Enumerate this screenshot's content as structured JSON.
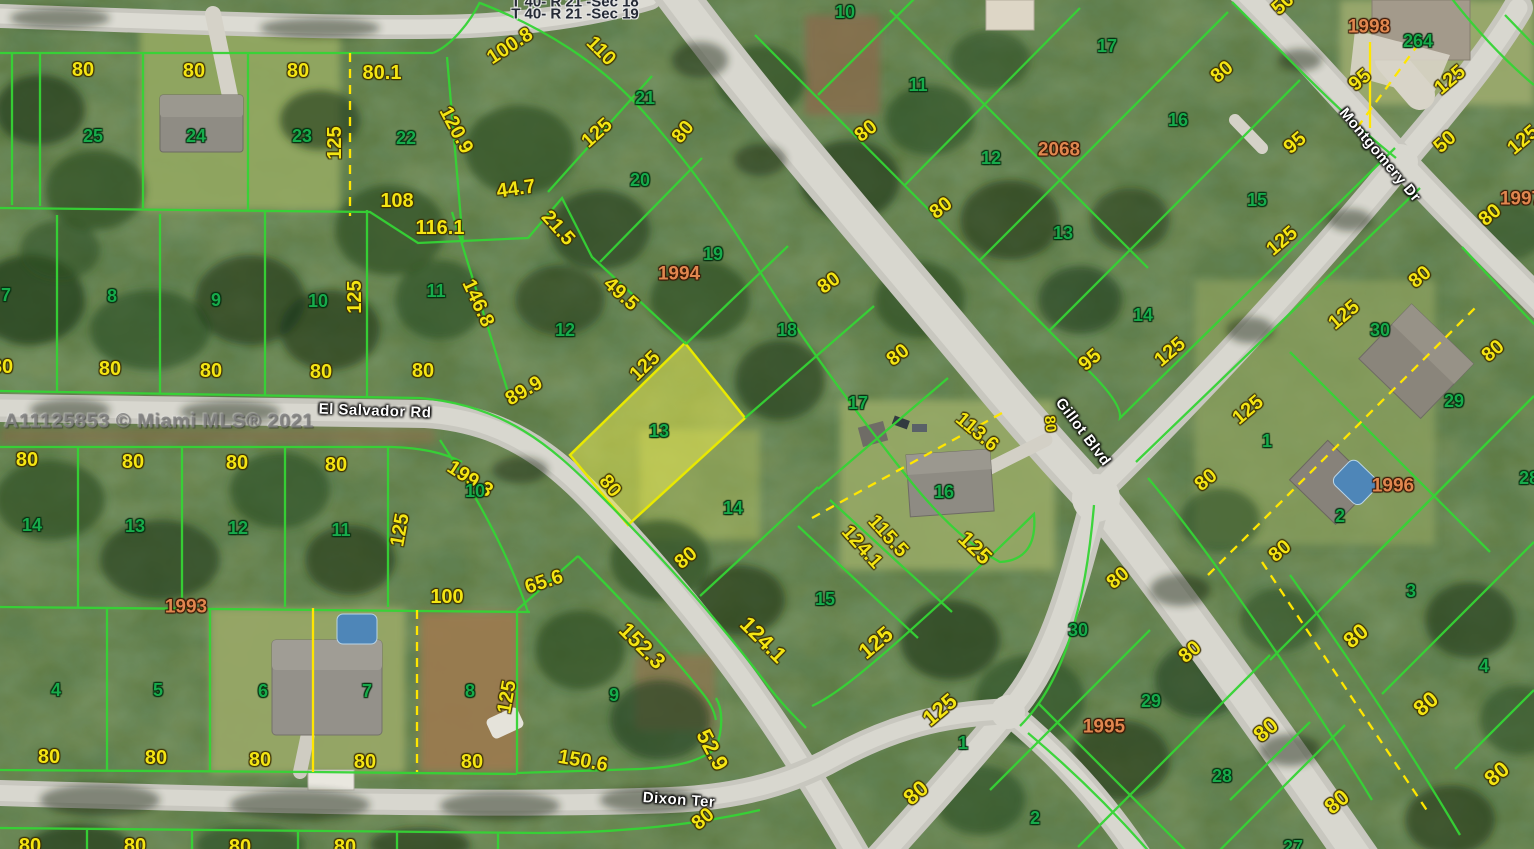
{
  "map": {
    "watermark": "A11125853 © Miami MLS® 2021",
    "section_labels": [
      "T 40- R 21 -Sec 18",
      "T 40- R 21 -Sec 19"
    ],
    "streets": [
      "El Salvador Rd",
      "Dixon Ter",
      "Gillot Blvd",
      "Montgomery Dr"
    ],
    "highlighted_lot": {
      "number": "13",
      "fill": "rgba(235,235,80,0.5)",
      "outline": "#e9e900"
    },
    "colors": {
      "parcel_line": "#35d435",
      "dimension_text": "#f4e513",
      "lot_number_text": "#17ab4b",
      "plat_number_text": "#e0874f",
      "boundary_yellow": "#ffe600",
      "street_text": "#ffffff"
    },
    "labels": [
      {
        "t": "T 40- R 21 -Sec 18",
        "x": 575,
        "y": 2,
        "c": "sec"
      },
      {
        "t": "T 40- R 21 -Sec 19",
        "x": 575,
        "y": 14,
        "c": "sec"
      },
      {
        "t": "El Salvador Rd",
        "x": 375,
        "y": 411,
        "r": 2,
        "c": "w"
      },
      {
        "t": "Dixon Ter",
        "x": 679,
        "y": 800,
        "r": 4,
        "c": "w"
      },
      {
        "t": "Gillot Blvd",
        "x": 1083,
        "y": 432,
        "r": 53,
        "c": "w"
      },
      {
        "t": "Montgomery Dr",
        "x": 1380,
        "y": 155,
        "r": 50,
        "c": "w"
      },
      {
        "t": "80",
        "x": 83,
        "y": 70,
        "c": "y"
      },
      {
        "t": "80",
        "x": 194,
        "y": 71,
        "c": "y"
      },
      {
        "t": "80",
        "x": 298,
        "y": 71,
        "c": "y"
      },
      {
        "t": "80.1",
        "x": 382,
        "y": 73,
        "c": "y"
      },
      {
        "t": "100.8",
        "x": 510,
        "y": 46,
        "r": -33,
        "c": "y"
      },
      {
        "t": "110",
        "x": 601,
        "y": 51,
        "r": 45,
        "c": "y"
      },
      {
        "t": "125",
        "x": 335,
        "y": 143,
        "r": -90,
        "c": "y"
      },
      {
        "t": "120.9",
        "x": 456,
        "y": 130,
        "r": 62,
        "c": "y"
      },
      {
        "t": "125",
        "x": 597,
        "y": 133,
        "r": -42,
        "c": "y"
      },
      {
        "t": "80",
        "x": 683,
        "y": 132,
        "r": -50,
        "c": "y"
      },
      {
        "t": "44.7",
        "x": 516,
        "y": 189,
        "r": -8,
        "c": "y"
      },
      {
        "t": "108",
        "x": 397,
        "y": 201,
        "c": "y"
      },
      {
        "t": "116.1",
        "x": 440,
        "y": 228,
        "c": "y"
      },
      {
        "t": "21.5",
        "x": 558,
        "y": 228,
        "r": 48,
        "c": "y"
      },
      {
        "t": "49.5",
        "x": 621,
        "y": 294,
        "r": 42,
        "c": "y"
      },
      {
        "t": "146.8",
        "x": 478,
        "y": 303,
        "r": 65,
        "c": "y"
      },
      {
        "t": "125",
        "x": 645,
        "y": 366,
        "r": -44,
        "c": "y"
      },
      {
        "t": "89.9",
        "x": 524,
        "y": 391,
        "r": -30,
        "c": "y"
      },
      {
        "t": "80",
        "x": 423,
        "y": 371,
        "c": "y"
      },
      {
        "t": "80",
        "x": 2,
        "y": 367,
        "c": "y"
      },
      {
        "t": "80",
        "x": 110,
        "y": 369,
        "c": "y"
      },
      {
        "t": "80",
        "x": 211,
        "y": 371,
        "c": "y"
      },
      {
        "t": "80",
        "x": 321,
        "y": 372,
        "c": "y"
      },
      {
        "t": "125",
        "x": 355,
        "y": 297,
        "r": -90,
        "c": "y"
      },
      {
        "t": "80",
        "x": 610,
        "y": 486,
        "r": 50,
        "c": "y"
      },
      {
        "t": "199.3",
        "x": 470,
        "y": 479,
        "r": 33,
        "c": "y"
      },
      {
        "t": "80",
        "x": 27,
        "y": 460,
        "c": "y"
      },
      {
        "t": "80",
        "x": 133,
        "y": 462,
        "c": "y"
      },
      {
        "t": "80",
        "x": 237,
        "y": 463,
        "c": "y"
      },
      {
        "t": "80",
        "x": 336,
        "y": 465,
        "c": "y"
      },
      {
        "t": "125",
        "x": 400,
        "y": 530,
        "r": -80,
        "c": "y"
      },
      {
        "t": "100",
        "x": 447,
        "y": 597,
        "c": "y"
      },
      {
        "t": "65.6",
        "x": 544,
        "y": 582,
        "r": -18,
        "c": "y"
      },
      {
        "t": "125",
        "x": 507,
        "y": 697,
        "r": -80,
        "c": "y"
      },
      {
        "t": "80",
        "x": 472,
        "y": 762,
        "c": "y"
      },
      {
        "t": "150.6",
        "x": 583,
        "y": 761,
        "r": 10,
        "c": "y"
      },
      {
        "t": "152.3",
        "x": 642,
        "y": 646,
        "r": 45,
        "fs": 22,
        "c": "y"
      },
      {
        "t": "124.1",
        "x": 763,
        "y": 640,
        "r": 45,
        "fs": 22,
        "c": "y"
      },
      {
        "t": "52.9",
        "x": 712,
        "y": 750,
        "r": 62,
        "fs": 22,
        "c": "y"
      },
      {
        "t": "80",
        "x": 49,
        "y": 757,
        "c": "y"
      },
      {
        "t": "80",
        "x": 156,
        "y": 758,
        "c": "y"
      },
      {
        "t": "80",
        "x": 260,
        "y": 760,
        "c": "y"
      },
      {
        "t": "80",
        "x": 365,
        "y": 762,
        "c": "y"
      },
      {
        "t": "80",
        "x": 30,
        "y": 846,
        "c": "y"
      },
      {
        "t": "80",
        "x": 135,
        "y": 846,
        "c": "y"
      },
      {
        "t": "80",
        "x": 240,
        "y": 847,
        "c": "y"
      },
      {
        "t": "80",
        "x": 345,
        "y": 847,
        "c": "y"
      },
      {
        "t": "80",
        "x": 686,
        "y": 558,
        "r": -40,
        "c": "y"
      },
      {
        "t": "124.1",
        "x": 862,
        "y": 547,
        "r": 48,
        "c": "y"
      },
      {
        "t": "115.5",
        "x": 888,
        "y": 536,
        "r": 48,
        "c": "y"
      },
      {
        "t": "125",
        "x": 876,
        "y": 643,
        "r": -40,
        "fs": 22,
        "c": "y"
      },
      {
        "t": "125",
        "x": 940,
        "y": 710,
        "r": -40,
        "fs": 22,
        "c": "y"
      },
      {
        "t": "80",
        "x": 916,
        "y": 793,
        "r": -40,
        "fs": 22,
        "c": "y"
      },
      {
        "t": "125",
        "x": 975,
        "y": 548,
        "r": 44,
        "fs": 22,
        "c": "y"
      },
      {
        "t": "113.6",
        "x": 977,
        "y": 432,
        "r": 40,
        "c": "y"
      },
      {
        "t": "80",
        "x": 1050,
        "y": 424,
        "r": 85,
        "fs": 15,
        "c": "y"
      },
      {
        "t": "80",
        "x": 829,
        "y": 283,
        "r": -36,
        "c": "y"
      },
      {
        "t": "80",
        "x": 898,
        "y": 355,
        "r": -38,
        "c": "y"
      },
      {
        "t": "80",
        "x": 866,
        "y": 131,
        "r": -38,
        "c": "y"
      },
      {
        "t": "80",
        "x": 941,
        "y": 208,
        "r": -38,
        "c": "y"
      },
      {
        "t": "95",
        "x": 1090,
        "y": 360,
        "r": -40,
        "c": "y"
      },
      {
        "t": "125",
        "x": 1170,
        "y": 352,
        "r": -40,
        "c": "y"
      },
      {
        "t": "80",
        "x": 1222,
        "y": 72,
        "r": -40,
        "c": "y"
      },
      {
        "t": "95",
        "x": 1295,
        "y": 143,
        "r": -40,
        "c": "y"
      },
      {
        "t": "95",
        "x": 1360,
        "y": 80,
        "r": -40,
        "c": "y"
      },
      {
        "t": "125",
        "x": 1450,
        "y": 80,
        "r": -40,
        "c": "y"
      },
      {
        "t": "50",
        "x": 1445,
        "y": 142,
        "r": -42,
        "c": "y"
      },
      {
        "t": "50",
        "x": 1283,
        "y": 4,
        "r": -42,
        "c": "y"
      },
      {
        "t": "125",
        "x": 1523,
        "y": 140,
        "r": -40,
        "c": "y"
      },
      {
        "t": "80",
        "x": 1490,
        "y": 215,
        "r": -40,
        "c": "y"
      },
      {
        "t": "125",
        "x": 1282,
        "y": 241,
        "r": -40,
        "c": "y"
      },
      {
        "t": "80",
        "x": 1420,
        "y": 277,
        "r": -40,
        "c": "y"
      },
      {
        "t": "125",
        "x": 1344,
        "y": 315,
        "r": -40,
        "c": "y"
      },
      {
        "t": "80",
        "x": 1493,
        "y": 351,
        "r": -40,
        "c": "y"
      },
      {
        "t": "125",
        "x": 1248,
        "y": 410,
        "r": -40,
        "c": "y"
      },
      {
        "t": "80",
        "x": 1206,
        "y": 480,
        "r": -40,
        "c": "y"
      },
      {
        "t": "80",
        "x": 1280,
        "y": 551,
        "r": -40,
        "c": "y"
      },
      {
        "t": "80",
        "x": 1118,
        "y": 578,
        "r": -40,
        "c": "y"
      },
      {
        "t": "80",
        "x": 1190,
        "y": 652,
        "r": -40,
        "c": "y"
      },
      {
        "t": "80",
        "x": 1356,
        "y": 636,
        "r": -40,
        "fs": 22,
        "c": "y"
      },
      {
        "t": "80",
        "x": 1426,
        "y": 704,
        "r": -40,
        "fs": 22,
        "c": "y"
      },
      {
        "t": "80",
        "x": 1497,
        "y": 774,
        "r": -40,
        "fs": 22,
        "c": "y"
      },
      {
        "t": "80",
        "x": 1266,
        "y": 730,
        "r": -40,
        "fs": 22,
        "c": "y"
      },
      {
        "t": "80",
        "x": 1337,
        "y": 802,
        "r": -40,
        "fs": 22,
        "c": "y"
      },
      {
        "t": "80",
        "x": 703,
        "y": 819,
        "r": -40,
        "c": "y"
      },
      {
        "t": "25",
        "x": 93,
        "y": 136,
        "c": "g"
      },
      {
        "t": "24",
        "x": 196,
        "y": 136,
        "c": "g"
      },
      {
        "t": "23",
        "x": 302,
        "y": 136,
        "c": "g"
      },
      {
        "t": "22",
        "x": 406,
        "y": 138,
        "c": "g"
      },
      {
        "t": "21",
        "x": 645,
        "y": 98,
        "c": "g"
      },
      {
        "t": "20",
        "x": 640,
        "y": 180,
        "c": "g"
      },
      {
        "t": "19",
        "x": 713,
        "y": 254,
        "c": "g"
      },
      {
        "t": "18",
        "x": 787,
        "y": 330,
        "c": "g"
      },
      {
        "t": "17",
        "x": 858,
        "y": 403,
        "c": "g"
      },
      {
        "t": "16",
        "x": 944,
        "y": 492,
        "c": "g"
      },
      {
        "t": "15",
        "x": 825,
        "y": 599,
        "c": "g"
      },
      {
        "t": "14",
        "x": 733,
        "y": 508,
        "c": "g"
      },
      {
        "t": "13",
        "x": 659,
        "y": 431,
        "c": "g"
      },
      {
        "t": "12",
        "x": 565,
        "y": 330,
        "c": "g"
      },
      {
        "t": "11",
        "x": 436,
        "y": 291,
        "c": "g"
      },
      {
        "t": "7",
        "x": 6,
        "y": 295,
        "c": "g"
      },
      {
        "t": "8",
        "x": 112,
        "y": 296,
        "c": "g"
      },
      {
        "t": "9",
        "x": 216,
        "y": 300,
        "c": "g"
      },
      {
        "t": "10",
        "x": 318,
        "y": 301,
        "c": "g"
      },
      {
        "t": "14",
        "x": 32,
        "y": 525,
        "c": "g"
      },
      {
        "t": "13",
        "x": 135,
        "y": 526,
        "c": "g"
      },
      {
        "t": "12",
        "x": 238,
        "y": 528,
        "c": "g"
      },
      {
        "t": "11",
        "x": 341,
        "y": 530,
        "c": "g"
      },
      {
        "t": "10",
        "x": 475,
        "y": 491,
        "c": "g"
      },
      {
        "t": "4",
        "x": 56,
        "y": 690,
        "c": "g"
      },
      {
        "t": "5",
        "x": 158,
        "y": 690,
        "c": "g"
      },
      {
        "t": "6",
        "x": 263,
        "y": 691,
        "c": "g"
      },
      {
        "t": "7",
        "x": 367,
        "y": 691,
        "c": "g"
      },
      {
        "t": "8",
        "x": 470,
        "y": 691,
        "c": "g"
      },
      {
        "t": "9",
        "x": 614,
        "y": 695,
        "c": "g"
      },
      {
        "t": "10",
        "x": 845,
        "y": 12,
        "c": "g"
      },
      {
        "t": "11",
        "x": 918,
        "y": 85,
        "c": "g"
      },
      {
        "t": "12",
        "x": 991,
        "y": 158,
        "c": "g"
      },
      {
        "t": "13",
        "x": 1063,
        "y": 233,
        "c": "g"
      },
      {
        "t": "14",
        "x": 1143,
        "y": 315,
        "c": "g"
      },
      {
        "t": "17",
        "x": 1107,
        "y": 46,
        "c": "g"
      },
      {
        "t": "16",
        "x": 1178,
        "y": 120,
        "c": "g"
      },
      {
        "t": "15",
        "x": 1257,
        "y": 200,
        "c": "g"
      },
      {
        "t": "264",
        "x": 1418,
        "y": 41,
        "c": "g"
      },
      {
        "t": "30",
        "x": 1380,
        "y": 330,
        "c": "g"
      },
      {
        "t": "29",
        "x": 1454,
        "y": 401,
        "c": "g"
      },
      {
        "t": "28",
        "x": 1529,
        "y": 478,
        "c": "g"
      },
      {
        "t": "1",
        "x": 1267,
        "y": 441,
        "c": "g"
      },
      {
        "t": "2",
        "x": 1340,
        "y": 516,
        "c": "g"
      },
      {
        "t": "30",
        "x": 1078,
        "y": 630,
        "c": "g"
      },
      {
        "t": "29",
        "x": 1151,
        "y": 701,
        "c": "g"
      },
      {
        "t": "28",
        "x": 1222,
        "y": 776,
        "c": "g"
      },
      {
        "t": "1",
        "x": 963,
        "y": 743,
        "c": "g"
      },
      {
        "t": "2",
        "x": 1035,
        "y": 818,
        "c": "g"
      },
      {
        "t": "3",
        "x": 1411,
        "y": 591,
        "c": "g"
      },
      {
        "t": "4",
        "x": 1484,
        "y": 666,
        "c": "g"
      },
      {
        "t": "27",
        "x": 1293,
        "y": 847,
        "c": "g"
      },
      {
        "t": "1994",
        "x": 679,
        "y": 274,
        "c": "o"
      },
      {
        "t": "2068",
        "x": 1059,
        "y": 150,
        "c": "o"
      },
      {
        "t": "1998",
        "x": 1369,
        "y": 27,
        "c": "o"
      },
      {
        "t": "1997",
        "x": 1521,
        "y": 199,
        "c": "o"
      },
      {
        "t": "1996",
        "x": 1393,
        "y": 486,
        "c": "o"
      },
      {
        "t": "1995",
        "x": 1104,
        "y": 727,
        "c": "o"
      },
      {
        "t": "1993",
        "x": 186,
        "y": 607,
        "c": "o"
      }
    ]
  }
}
